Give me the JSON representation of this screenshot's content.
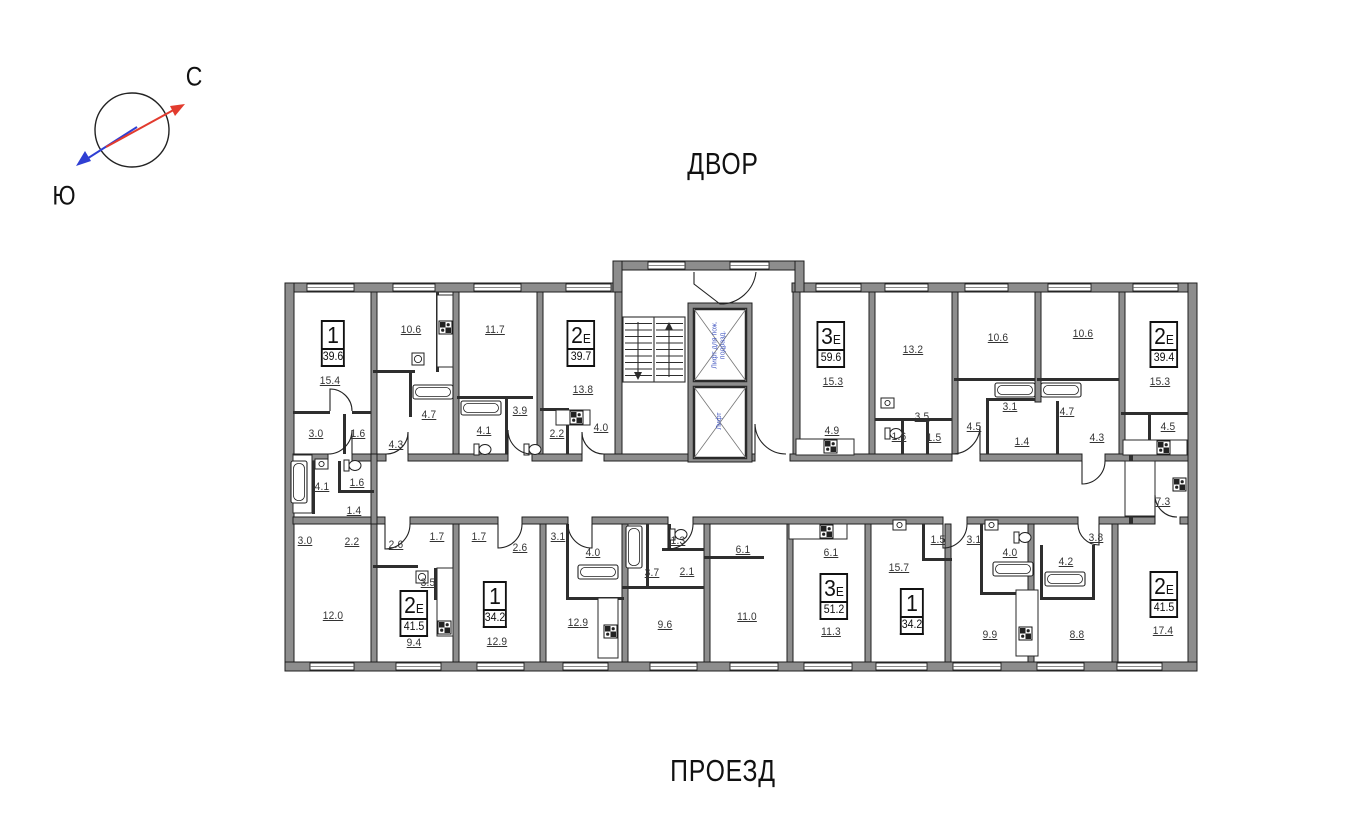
{
  "compass": {
    "north_label": "С",
    "south_label": "Ю"
  },
  "site_labels": {
    "courtyard": "ДВОР",
    "driveway": "ПРОЕЗД"
  },
  "elevators": {
    "fire_elevator_label": "Лифт для пож. подразд.",
    "elevator_label": "Лифт"
  },
  "colors": {
    "wall": "#8d8d8d",
    "outline": "#1f1f1f",
    "thin_wall": "#2e2e2e",
    "accent_blue": "#4a5ec4",
    "north_red": "#e23b2e",
    "south_blue": "#2f3fd3"
  },
  "apartments": [
    {
      "type": "1",
      "suffix": "",
      "total_area": "39.6",
      "x": 333,
      "y": 320
    },
    {
      "type": "2",
      "suffix": "Е",
      "total_area": "39.7",
      "x": 581,
      "y": 320
    },
    {
      "type": "3",
      "suffix": "Е",
      "total_area": "59.6",
      "x": 831,
      "y": 321
    },
    {
      "type": "2",
      "suffix": "Е",
      "total_area": "39.4",
      "x": 1164,
      "y": 321
    },
    {
      "type": "2",
      "suffix": "Е",
      "total_area": "41.5",
      "x": 414,
      "y": 590
    },
    {
      "type": "1",
      "suffix": "",
      "total_area": "34.2",
      "x": 495,
      "y": 581
    },
    {
      "type": "3",
      "suffix": "Е",
      "total_area": "51.2",
      "x": 834,
      "y": 573
    },
    {
      "type": "1",
      "suffix": "",
      "total_area": "34.2",
      "x": 912,
      "y": 588
    },
    {
      "type": "2",
      "suffix": "Е",
      "total_area": "41.5",
      "x": 1164,
      "y": 571
    }
  ],
  "room_areas": [
    {
      "value": "15.4",
      "x": 330,
      "y": 381
    },
    {
      "value": "3.0",
      "x": 316,
      "y": 434
    },
    {
      "value": "1.6",
      "x": 358,
      "y": 434
    },
    {
      "value": "10.6",
      "x": 411,
      "y": 330
    },
    {
      "value": "4.7",
      "x": 429,
      "y": 415
    },
    {
      "value": "4.3",
      "x": 396,
      "y": 445
    },
    {
      "value": "11.7",
      "x": 495,
      "y": 330
    },
    {
      "value": "4.1",
      "x": 484,
      "y": 431
    },
    {
      "value": "3.9",
      "x": 520,
      "y": 411
    },
    {
      "value": "2.2",
      "x": 557,
      "y": 434
    },
    {
      "value": "13.8",
      "x": 583,
      "y": 390
    },
    {
      "value": "4.0",
      "x": 601,
      "y": 428
    },
    {
      "value": "15.3",
      "x": 833,
      "y": 382
    },
    {
      "value": "13.2",
      "x": 913,
      "y": 350
    },
    {
      "value": "4.9",
      "x": 832,
      "y": 431
    },
    {
      "value": "3.5",
      "x": 922,
      "y": 417
    },
    {
      "value": "1.6",
      "x": 899,
      "y": 437
    },
    {
      "value": "1.5",
      "x": 934,
      "y": 438
    },
    {
      "value": "4.5",
      "x": 974,
      "y": 427
    },
    {
      "value": "3.1",
      "x": 1010,
      "y": 407
    },
    {
      "value": "1.4",
      "x": 1022,
      "y": 442
    },
    {
      "value": "10.6",
      "x": 998,
      "y": 338
    },
    {
      "value": "4.7",
      "x": 1067,
      "y": 412
    },
    {
      "value": "10.6",
      "x": 1083,
      "y": 334
    },
    {
      "value": "4.3",
      "x": 1097,
      "y": 438
    },
    {
      "value": "15.3",
      "x": 1160,
      "y": 382
    },
    {
      "value": "4.5",
      "x": 1168,
      "y": 427
    },
    {
      "value": "4.1",
      "x": 322,
      "y": 487
    },
    {
      "value": "1.6",
      "x": 357,
      "y": 483
    },
    {
      "value": "1.4",
      "x": 354,
      "y": 511
    },
    {
      "value": "7.3",
      "x": 1163,
      "y": 502
    },
    {
      "value": "3.0",
      "x": 305,
      "y": 541
    },
    {
      "value": "2.2",
      "x": 352,
      "y": 542
    },
    {
      "value": "2.6",
      "x": 396,
      "y": 545
    },
    {
      "value": "1.7",
      "x": 437,
      "y": 537
    },
    {
      "value": "1.7",
      "x": 479,
      "y": 537
    },
    {
      "value": "2.6",
      "x": 520,
      "y": 548
    },
    {
      "value": "3.1",
      "x": 558,
      "y": 537
    },
    {
      "value": "4.0",
      "x": 593,
      "y": 553
    },
    {
      "value": "12.0",
      "x": 333,
      "y": 616
    },
    {
      "value": "3.5",
      "x": 428,
      "y": 583
    },
    {
      "value": "9.4",
      "x": 414,
      "y": 643
    },
    {
      "value": "12.9",
      "x": 497,
      "y": 642
    },
    {
      "value": "12.9",
      "x": 578,
      "y": 623
    },
    {
      "value": "1.3",
      "x": 678,
      "y": 541
    },
    {
      "value": "3.7",
      "x": 652,
      "y": 573
    },
    {
      "value": "2.1",
      "x": 687,
      "y": 572
    },
    {
      "value": "9.6",
      "x": 665,
      "y": 625
    },
    {
      "value": "6.1",
      "x": 743,
      "y": 550
    },
    {
      "value": "11.0",
      "x": 747,
      "y": 617
    },
    {
      "value": "6.1",
      "x": 831,
      "y": 553
    },
    {
      "value": "11.3",
      "x": 831,
      "y": 632
    },
    {
      "value": "1.5",
      "x": 938,
      "y": 540
    },
    {
      "value": "3.1",
      "x": 974,
      "y": 540
    },
    {
      "value": "4.0",
      "x": 1010,
      "y": 553
    },
    {
      "value": "15.7",
      "x": 899,
      "y": 568
    },
    {
      "value": "9.9",
      "x": 990,
      "y": 635
    },
    {
      "value": "3.8",
      "x": 1096,
      "y": 538
    },
    {
      "value": "4.2",
      "x": 1066,
      "y": 562
    },
    {
      "value": "8.8",
      "x": 1077,
      "y": 635
    },
    {
      "value": "17.4",
      "x": 1163,
      "y": 631
    }
  ]
}
